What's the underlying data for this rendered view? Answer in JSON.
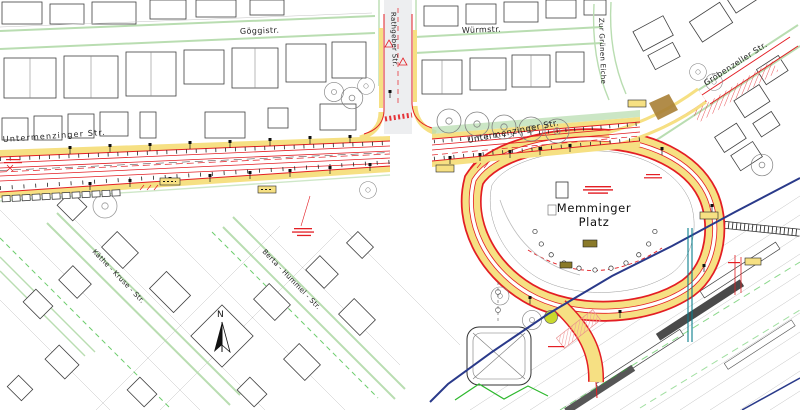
{
  "map": {
    "street_labels": {
      "goeggistr": "Göggistr.",
      "wuermstr": "Würmstr.",
      "rathgeber_str": "Rathgeber  Str.",
      "zur_gruenen_eiche": "Zur  Grünen  Eiche",
      "groebenzeller_str": "Gröbenzeller Str.",
      "untermenzinger_str_west": "Untermenzinger   Str.",
      "untermenzinger_str_east": "Untermenzinger Str.",
      "kaethe_kruse_str": "Käthe - Kruse - Str.",
      "berta_hummel_str": "Berta - Hummel - Str."
    },
    "plaza": {
      "name_line1": "Memminger",
      "name_line2": "Platz"
    },
    "compass": {
      "north": "N"
    },
    "colors": {
      "construction_red": "#e31e24",
      "surface_yellow": "#f6e083",
      "boundary_green_light": "#b9ddb1",
      "boundary_green_bright": "#2eb82e",
      "utility_blue": "#2a3a8a",
      "utility_teal": "#0a7d8c",
      "road_gray": "#e9eaec",
      "highlight_lime": "#c9d92e",
      "hatch_pink": "#ef9a9a",
      "patch_brown": "#a97f35"
    }
  }
}
